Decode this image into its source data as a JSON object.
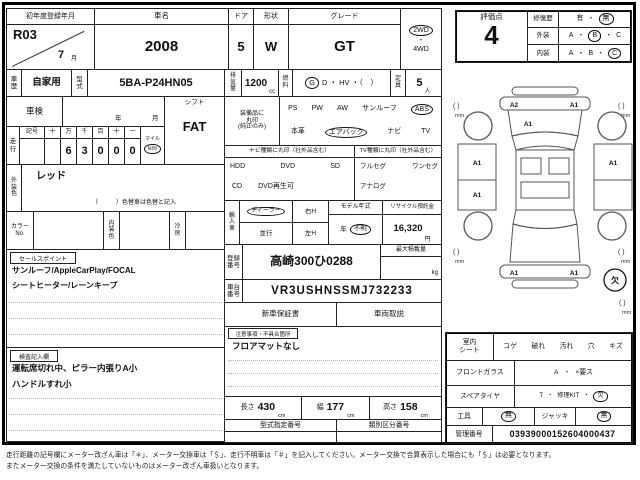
{
  "colors": {
    "ink": "#111111",
    "line": "#222222",
    "paper": "#ffffff"
  },
  "row1": {
    "first_reg_label": "初年度登録年月",
    "first_reg_year": "R03",
    "first_reg_month": "7",
    "month_unit": "月",
    "car_name_label": "車名",
    "car_name": "2008",
    "door_label": "ドア",
    "door": "5",
    "shape_label": "形状",
    "shape": "W",
    "grade_label": "グレード",
    "grade": "GT",
    "drive_2wd": "2WD",
    "drive_4wd": "4WD"
  },
  "row2": {
    "history_label": "車\n歴",
    "history": "自家用",
    "model_code_label": "型\n式",
    "model_code": "5BA-P24HN05",
    "displacement_label": "排\n気\n量",
    "displacement": "1200",
    "displacement_unit": "cc",
    "fuel_label": "燃\n料",
    "fuel_circled": "G",
    "fuel_rest": "D ・ HV ・（　）",
    "capacity_label": "定\n員",
    "capacity": "5",
    "capacity_unit": "人"
  },
  "shaken": {
    "label": "車検",
    "year_unit": "年",
    "month_unit": "月"
  },
  "mileage": {
    "label": "走\n行",
    "headers": [
      "記号",
      "十",
      "万",
      "千",
      "百",
      "十",
      "一"
    ],
    "digits": [
      "",
      "",
      "6",
      "3",
      "0",
      "0",
      "0"
    ],
    "mile_label": "マイル",
    "km_label": "km"
  },
  "shift": {
    "label": "シフト",
    "value": "FAT"
  },
  "equipment": {
    "label": "装備品に\n丸印\n(純正のみ)",
    "row1": [
      "PS",
      "PW",
      "AW",
      "サンルーフ",
      "ABS"
    ],
    "row2": [
      "本革",
      "エアバック",
      "ナビ",
      "TV"
    ]
  },
  "nav": {
    "header": "ナビ種類に丸印（社外品含む）",
    "items1": [
      "HDD",
      "DVD",
      "SD"
    ],
    "items2": [
      "CD",
      "DVD再生可"
    ]
  },
  "tv": {
    "header": "TV種類に丸印（社外品含む）",
    "items1": [
      "フルセグ",
      "ワンセグ"
    ],
    "items2": [
      "アナログ"
    ]
  },
  "ext_color": {
    "label": "外\n装\n色",
    "value": "レッド",
    "note": "（　　　）色替車は色替と記入"
  },
  "color_row": {
    "color_no_label": "カラー\nNo.",
    "interior_label": "内\n装\n色",
    "ac_label": "冷\n房"
  },
  "import_car": {
    "label": "輸\n入\n車",
    "dealer": "ディーラー",
    "parallel": "並行",
    "right_h": "右H",
    "left_h": "左H",
    "model_year_label": "モデル年式",
    "year_unit": "年",
    "unknown": "不明",
    "recycle_label": "リサイクル預託金",
    "recycle_value": "16,320",
    "yen": "円"
  },
  "registration": {
    "label": "登録\n番号",
    "value": "高崎300ひ0288",
    "max_load_label": "最大積載量",
    "kg": "kg"
  },
  "chassis": {
    "label": "車台\n番号",
    "value": "VR3USHNSSMJ732233"
  },
  "docs": {
    "warranty": "新車保証書",
    "manual": "車両取説"
  },
  "cautions": {
    "tag": "注意事項・不具合箇所",
    "line1": "フロアマットなし"
  },
  "dims": {
    "length_label": "長さ",
    "length": "430",
    "width_label": "幅",
    "width": "177",
    "height_label": "高さ",
    "height": "158",
    "cm": "cm"
  },
  "type_numbers": {
    "designation": "型式指定番号",
    "classification": "類別区分番号"
  },
  "sales_points": {
    "tag": "セールスポイント",
    "line1": "サンルーフ/AppleCarPlay/FOCAL",
    "line2": "シートヒーター/レーンキープ"
  },
  "inspector": {
    "tag": "検査記入欄",
    "line1": "運転席切れ中、ピラー内張りA小",
    "line2": "ハンドルすれ小"
  },
  "evaluation": {
    "score_label": "評価点",
    "score": "4",
    "repair_label": "修復歴",
    "repair_yes": "有",
    "repair_no": "無",
    "exterior_label": "外装",
    "interior_label": "内装",
    "grade_a": "A",
    "grade_b": "B",
    "grade_c": "C"
  },
  "diagram": {
    "front_bumper_left": "A2",
    "front_bumper_right": "A1",
    "hood": "A1",
    "left_front_door": "A1",
    "left_rear_door": "A1",
    "right_front_door": "A1",
    "rear_bumper_left": "A1",
    "rear_bumper_right": "A1",
    "corner_mark": "(  )",
    "mm": "mm",
    "missing": "欠"
  },
  "condition": {
    "seat_label": "室内\nシート",
    "seat_options": [
      "コゲ",
      "破れ",
      "汚れ",
      "穴",
      "キズ"
    ],
    "glass_label": "フロントガラス",
    "glass_a": "A",
    "glass_x": "×要ス",
    "spare_label": "スペアタイヤ",
    "spare_t": "T",
    "spare_kit": "修理KIT",
    "spare_missing": "欠",
    "tools_label": "工具",
    "tools_value": "無",
    "jack_label": "ジャッキ",
    "jack_value": "無",
    "mgmt_label": "管理番号",
    "mgmt_value": "03939000152604000437"
  },
  "misc": {
    "dot": "・"
  },
  "disclaimer": {
    "line1": "走行距離の記号欄にメーター改ざん車は「＊」、メーター交換車は「＄」、走行不明車は「＃」を記入してください。メーター交換で合算表示した場合にも「＄」は必要となります。",
    "line2": "またメーター交換の条件を満たしていないものはメーター改ざん車扱いとなります。"
  }
}
